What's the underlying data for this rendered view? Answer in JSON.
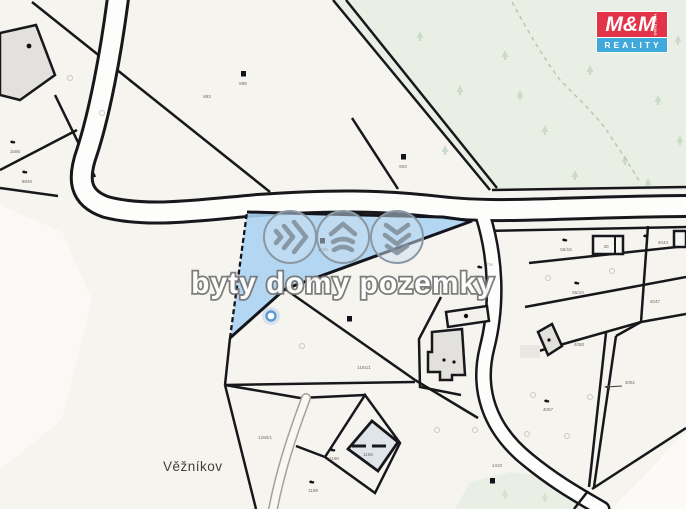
{
  "map": {
    "place_label": "Věžníkov",
    "watermark": {
      "text": "byty domy pozemky",
      "tm": "™"
    },
    "logo": {
      "name": "M&M",
      "tagline": "REALITY",
      "side_text": "HOLDING",
      "red": "#e23349",
      "blue": "#3fa9dc"
    },
    "highlighted_parcel": {
      "color": "#aad3f2",
      "label": "1186"
    },
    "parcel_labels": [
      {
        "text": "898",
        "x": 243,
        "y": 85
      },
      {
        "text": "893",
        "x": 207,
        "y": 98
      },
      {
        "text": "903",
        "x": 403,
        "y": 168
      },
      {
        "text": "1586",
        "x": 15,
        "y": 153
      },
      {
        "text": "8940",
        "x": 27,
        "y": 183
      },
      {
        "text": "1186",
        "x": 323,
        "y": 251
      },
      {
        "text": "55/8",
        "x": 481,
        "y": 279
      },
      {
        "text": "55/15",
        "x": 566,
        "y": 251
      },
      {
        "text": "30",
        "x": 606,
        "y": 248
      },
      {
        "text": "4043",
        "x": 663,
        "y": 244
      },
      {
        "text": "55/10",
        "x": 578,
        "y": 294
      },
      {
        "text": "4047",
        "x": 655,
        "y": 303
      },
      {
        "text": "4050",
        "x": 579,
        "y": 346
      },
      {
        "text": "4051",
        "x": 630,
        "y": 384
      },
      {
        "text": "1191/1",
        "x": 364,
        "y": 369
      },
      {
        "text": "1185",
        "x": 368,
        "y": 456
      },
      {
        "text": "1190",
        "x": 334,
        "y": 460
      },
      {
        "text": "1189",
        "x": 313,
        "y": 492
      },
      {
        "text": "1260/1",
        "x": 265,
        "y": 439
      },
      {
        "text": "1410",
        "x": 497,
        "y": 467
      },
      {
        "text": "4057",
        "x": 548,
        "y": 411
      }
    ]
  }
}
